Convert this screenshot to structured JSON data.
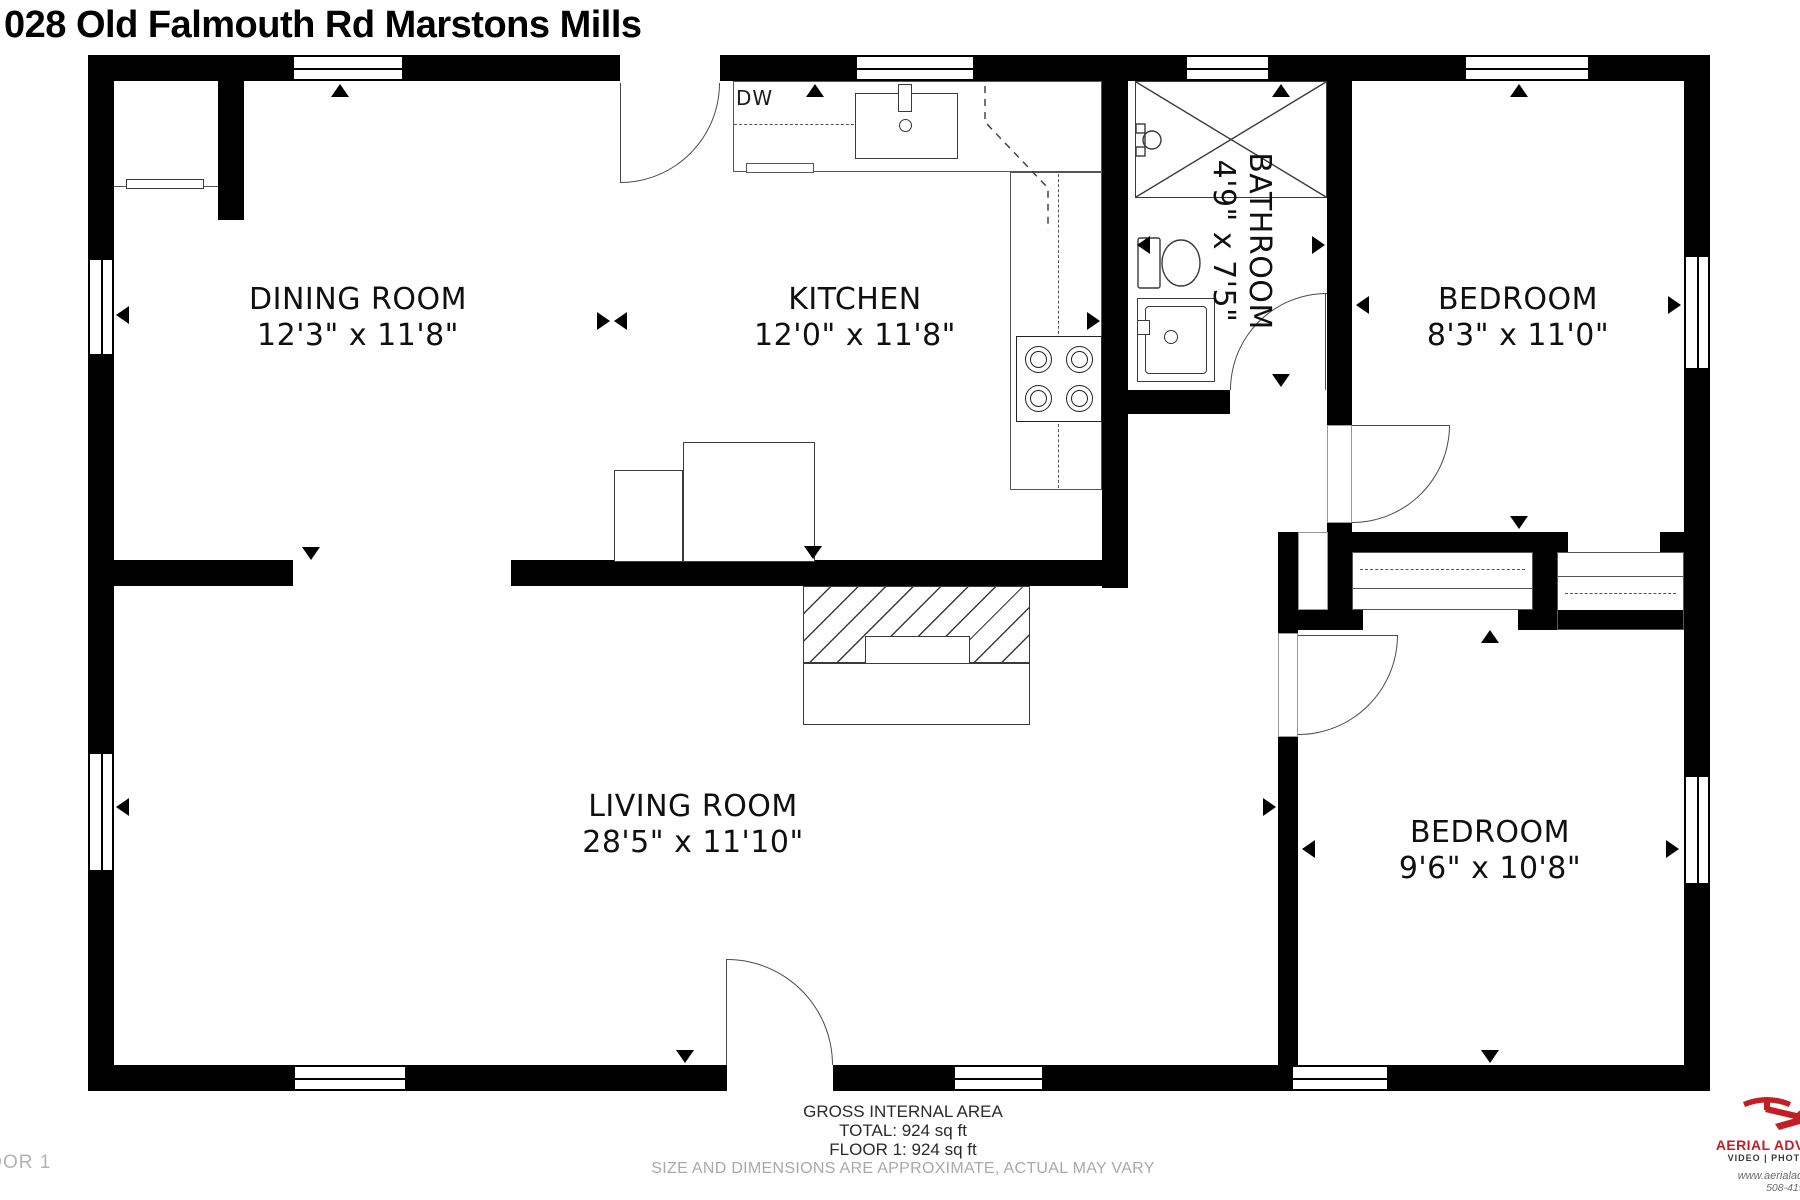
{
  "title": "028 Old Falmouth Rd Marstons Mills",
  "floor_label": "FLOOR 1",
  "rooms": [
    {
      "name": "DINING ROOM",
      "dims": "12'3\" x 11'8\""
    },
    {
      "name": "KITCHEN",
      "dims": "12'0\" x 11'8\""
    },
    {
      "name": "BATHROOM",
      "dims": "4'9\" x 7'5\""
    },
    {
      "name": "BEDROOM",
      "dims": "8'3\" x 11'0\""
    },
    {
      "name": "LIVING ROOM",
      "dims": "28'5\" x 11'10\""
    },
    {
      "name": "BEDROOM",
      "dims": "9'6\" x 10'8\""
    }
  ],
  "labels": {
    "dishwasher": "DW"
  },
  "footer": {
    "area_title": "GROSS INTERNAL AREA",
    "total": "TOTAL: 924 sq ft",
    "floor1": "FLOOR 1: 924 sq ft",
    "disclaimer": "SIZE AND DIMENSIONS ARE APPROXIMATE, ACTUAL MAY VARY"
  },
  "logo": {
    "brand": "AERIAL ADVANTAGE",
    "tagline": "VIDEO | PHOTOGRAPHY",
    "website": "www.aerialadvantage",
    "phone": "508-419-6",
    "accent_color": "#c41e25"
  },
  "icons": {
    "dimension_arrow": "black-triangle",
    "logo_mark": "drone-quadcopter"
  },
  "colors": {
    "wall": "#000000",
    "fixture_line": "#3a3a3a",
    "muted_text": "#a9a9a9"
  }
}
